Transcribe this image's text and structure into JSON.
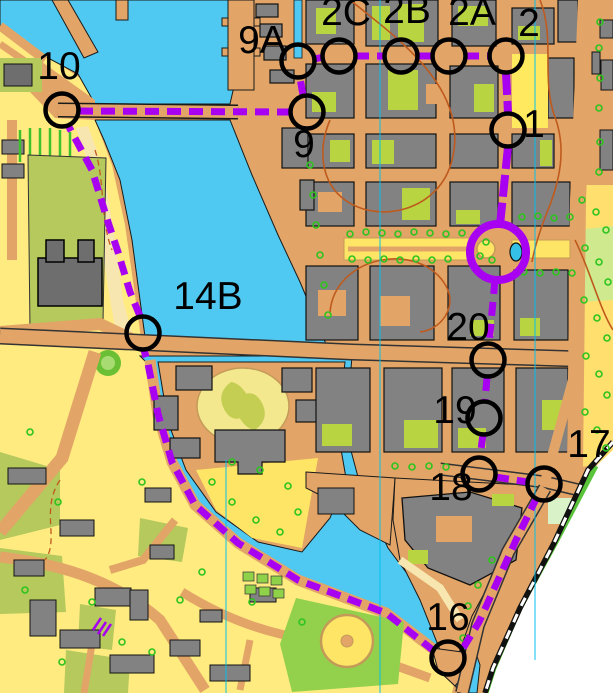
{
  "map": {
    "name": "sprint-orienteering-course-map",
    "colors": {
      "water": "#4fc9f1",
      "paved": "#e2a567",
      "open_yellow": "#ffeb80",
      "sand": "#f7e6b0",
      "olive": "#b5c95c",
      "courtyard_green": "#b8d440",
      "park_yellow": "#ffdf6e",
      "bright_green": "#93d14c",
      "building": "#828282",
      "building_outline": "#1a1a1a",
      "contour_brown": "#bf5a1e",
      "north_line": "#00c0f0",
      "railway": "#111111",
      "out_of_map": "#ffffff",
      "course_purple": "#a800f0",
      "tree_green": "#2ec41e"
    },
    "course": {
      "label_font_px": 39,
      "circle_radius": 16.5,
      "circle_stroke": 4.5,
      "ring": {
        "x": 498,
        "y": 252,
        "r": 28,
        "stroke": 8
      },
      "controls": [
        {
          "id": "1",
          "x": 508,
          "y": 130,
          "lx": 534,
          "ly": 137
        },
        {
          "id": "2",
          "x": 506,
          "y": 56,
          "lx": 529,
          "ly": 36
        },
        {
          "id": "2A",
          "x": 449,
          "y": 56,
          "lx": 472,
          "ly": 25
        },
        {
          "id": "2B",
          "x": 401,
          "y": 56,
          "lx": 407,
          "ly": 23
        },
        {
          "id": "2C",
          "x": 339,
          "y": 56,
          "lx": 346,
          "ly": 25
        },
        {
          "id": "9A",
          "x": 298,
          "y": 61,
          "lx": 262,
          "ly": 53
        },
        {
          "id": "9",
          "x": 307,
          "y": 112,
          "lx": 304,
          "ly": 157
        },
        {
          "id": "10",
          "x": 62,
          "y": 110,
          "lx": 59,
          "ly": 79
        },
        {
          "id": "14B",
          "x": 143,
          "y": 333,
          "lx": 208,
          "ly": 309
        },
        {
          "id": "16",
          "x": 448,
          "y": 658,
          "lx": 448,
          "ly": 630
        },
        {
          "id": "17",
          "x": 544,
          "y": 484,
          "lx": 589,
          "ly": 457
        },
        {
          "id": "18",
          "x": 479,
          "y": 474,
          "lx": 451,
          "ly": 500
        },
        {
          "id": "19",
          "x": 484,
          "y": 418,
          "lx": 455,
          "ly": 423
        },
        {
          "id": "20",
          "x": 488,
          "y": 360,
          "lx": 468,
          "ly": 340
        }
      ],
      "legs": [
        {
          "name": "9A-2C",
          "style": "dashed",
          "pts": [
            [
              314,
              59
            ],
            [
              324,
              57
            ]
          ]
        },
        {
          "name": "2C-2B",
          "style": "dashed",
          "pts": [
            [
              355,
              56
            ],
            [
              385,
              56
            ]
          ]
        },
        {
          "name": "2B-2A",
          "style": "dashed",
          "pts": [
            [
              417,
              56
            ],
            [
              433,
              56
            ]
          ]
        },
        {
          "name": "2A-2",
          "style": "dashed",
          "pts": [
            [
              465,
              56
            ],
            [
              490,
              56
            ]
          ]
        },
        {
          "name": "2-1",
          "style": "solid",
          "pts": [
            [
              506,
              73
            ],
            [
              508,
              113
            ]
          ]
        },
        {
          "name": "1-ring",
          "style": "solid",
          "pts": [
            [
              508,
              147
            ],
            [
              500,
              225
            ]
          ]
        },
        {
          "name": "ring-20",
          "style": "dashed",
          "pts": [
            [
              495,
              280
            ],
            [
              489,
              344
            ]
          ]
        },
        {
          "name": "20-19",
          "style": "dashed",
          "pts": [
            [
              487,
              377
            ],
            [
              485,
              402
            ]
          ]
        },
        {
          "name": "19-18",
          "style": "dashed",
          "pts": [
            [
              483,
              434
            ],
            [
              480,
              458
            ]
          ]
        },
        {
          "name": "18-17",
          "style": "dashed",
          "pts": [
            [
              495,
              477
            ],
            [
              528,
              482
            ]
          ]
        },
        {
          "name": "17-16",
          "style": "dashed",
          "pts": [
            [
              537,
              497
            ],
            [
              517,
              538
            ],
            [
              499,
              578
            ],
            [
              479,
              622
            ],
            [
              462,
              650
            ]
          ]
        },
        {
          "name": "16-shore",
          "style": "dashed",
          "pts": [
            [
              434,
              651
            ],
            [
              386,
              613
            ],
            [
              298,
              580
            ],
            [
              238,
              543
            ],
            [
              195,
              505
            ],
            [
              172,
              462
            ],
            [
              158,
              414
            ],
            [
              148,
              364
            ],
            [
              144,
              350
            ]
          ]
        },
        {
          "name": "14B-up",
          "style": "dashed",
          "pts": [
            [
              140,
              316
            ],
            [
              130,
              292
            ],
            [
              118,
              252
            ],
            [
              108,
              222
            ],
            [
              92,
              170
            ],
            [
              69,
              127
            ]
          ]
        },
        {
          "name": "10-9",
          "style": "dashed",
          "pts": [
            [
              79,
              111
            ],
            [
              290,
              112
            ]
          ]
        },
        {
          "name": "9-9A",
          "style": "dashed",
          "pts": [
            [
              303,
              95
            ],
            [
              300,
              78
            ]
          ]
        }
      ]
    }
  }
}
